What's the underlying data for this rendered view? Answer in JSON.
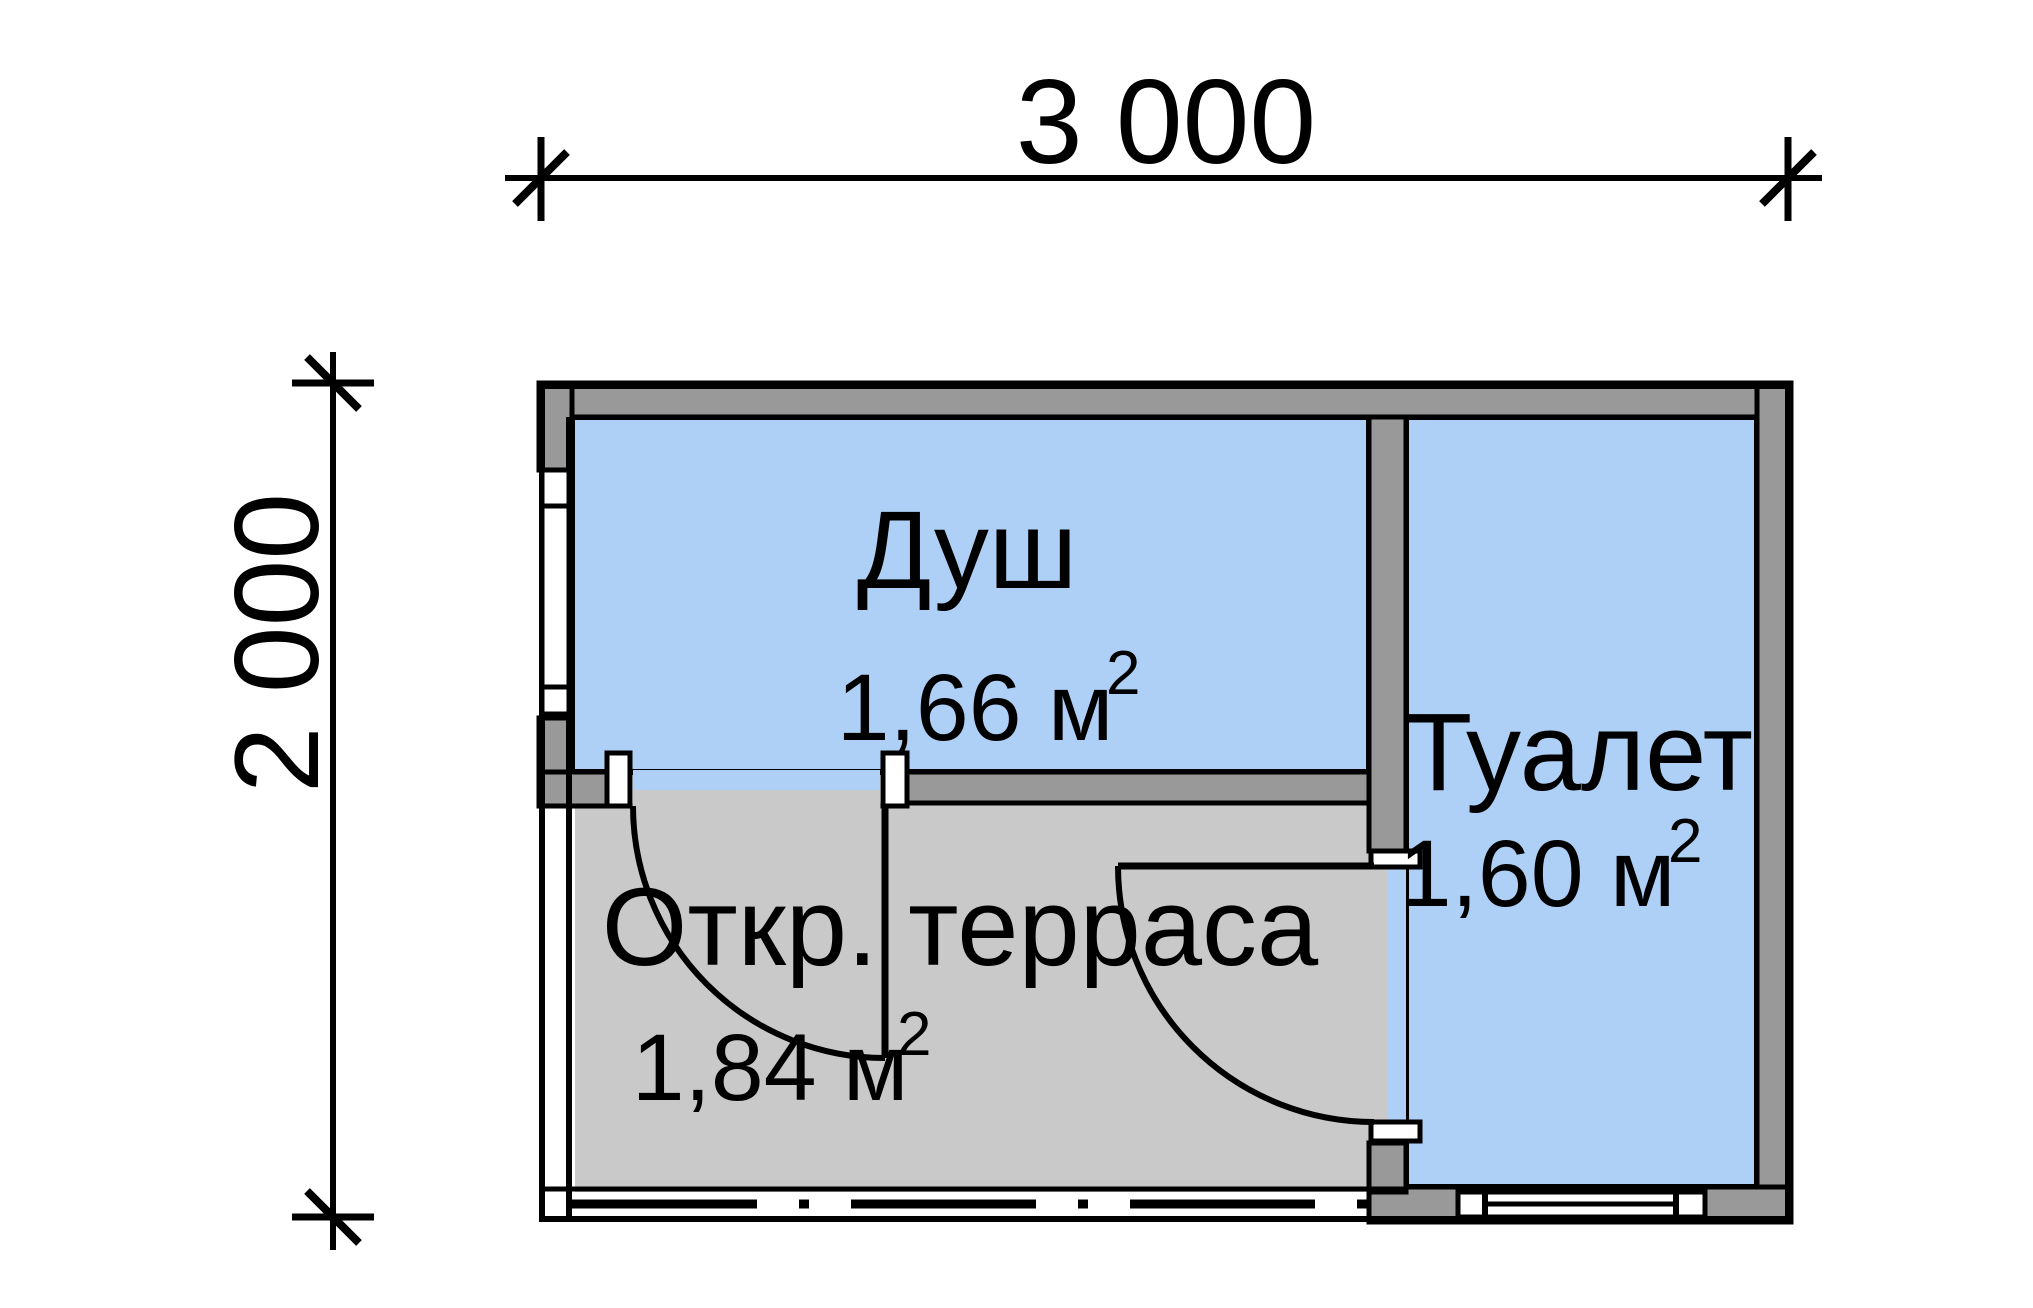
{
  "dimensions": {
    "width_label": "3 000",
    "height_label": "2 000"
  },
  "rooms": [
    {
      "name": "Душ",
      "area": "1,66 м",
      "area_sup": "2"
    },
    {
      "name": "Туалет",
      "area": "1,60 м",
      "area_sup": "2"
    },
    {
      "name": "Откр. терраса",
      "area": "1,84 м",
      "area_sup": "2"
    }
  ],
  "colors": {
    "background": "#ffffff",
    "room_fill": "#aed0f6",
    "wall_fill": "#999999",
    "terrace_fill": "#c9c9c9",
    "line": "#000000"
  }
}
